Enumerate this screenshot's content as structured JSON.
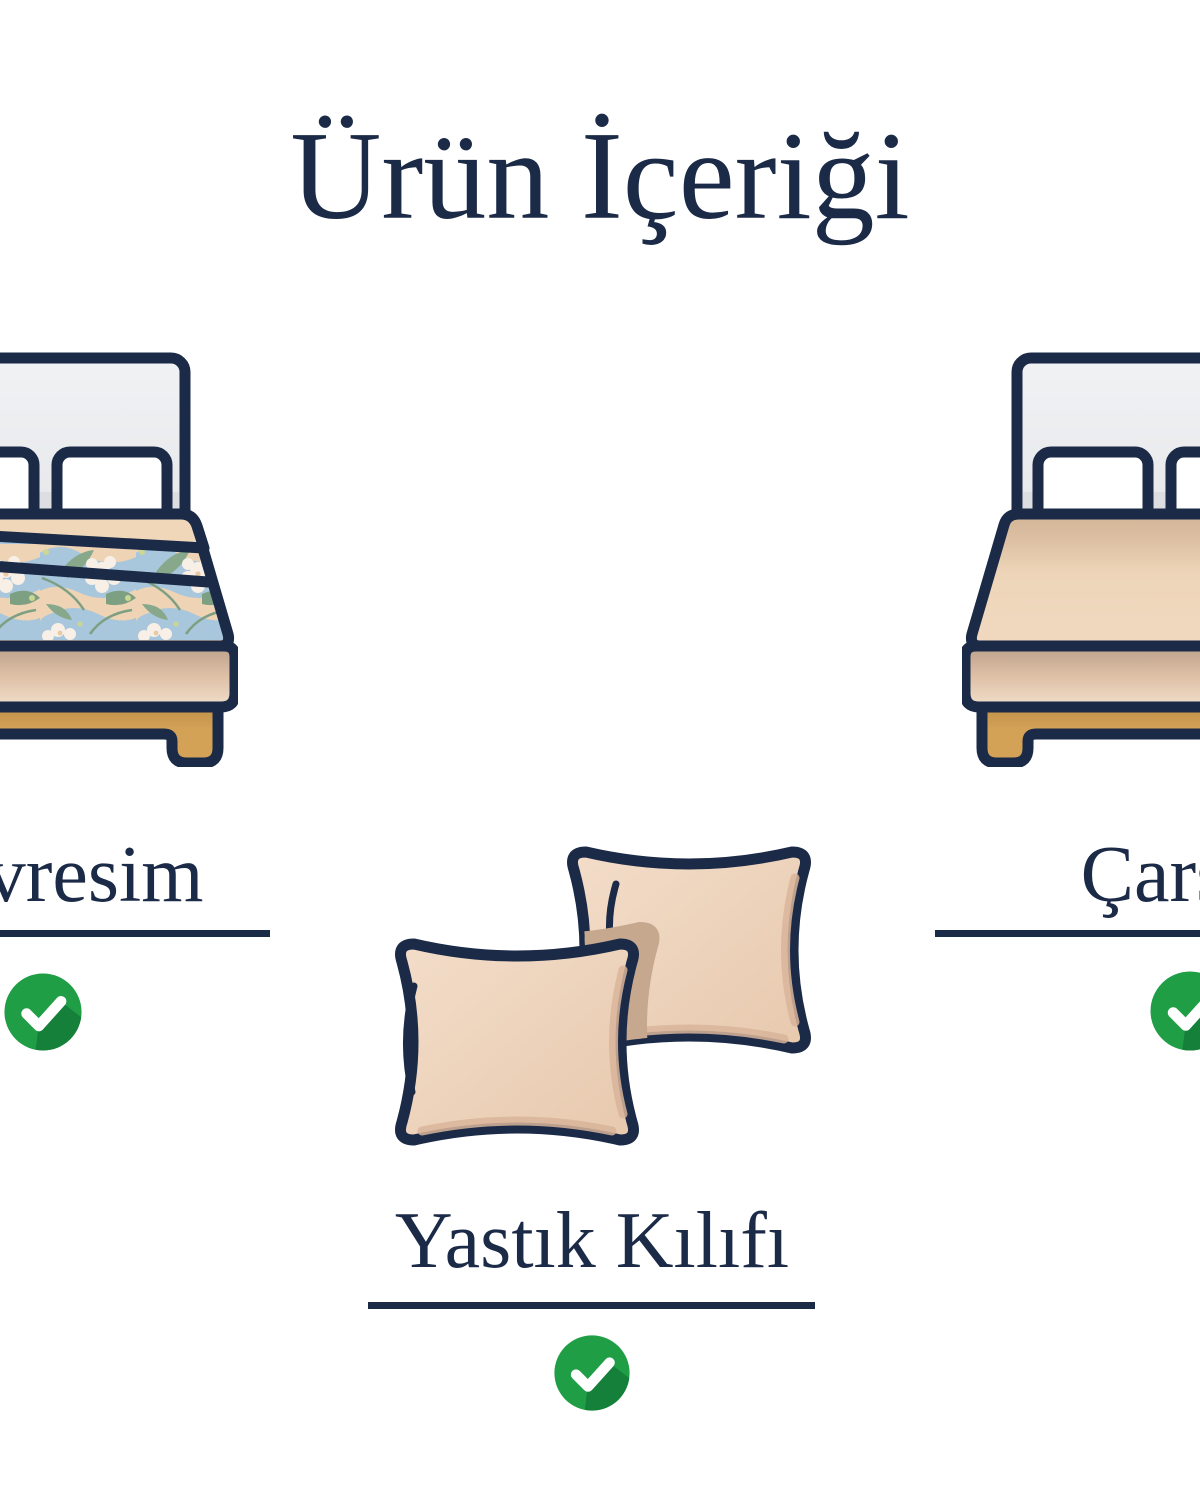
{
  "page": {
    "title": "Ürün İçeriği",
    "background": "#ffffff"
  },
  "items": [
    {
      "id": "nevresim",
      "label": "Nevresim",
      "included": true,
      "illustration": "bed-with-floral-duvet"
    },
    {
      "id": "yastik-kilifi",
      "label": "Yastık Kılıfı",
      "included": true,
      "illustration": "two-pillows"
    },
    {
      "id": "carsaf",
      "label": "Çarşaf",
      "included": true,
      "illustration": "bed-with-fitted-sheet"
    }
  ],
  "colors": {
    "navy": "#1b2a47",
    "check_green": "#1f9e45",
    "check_green_shadow": "#15803a",
    "check_mark": "#ffffff",
    "peach_fabric": "#eed6bb",
    "pillow_peach": "#ecd2ba",
    "headboard_gray": "#ededef",
    "wood_tan": "#d3a257",
    "duvet_blue": "#a9c7dc",
    "duvet_leaf_green": "#87a88b",
    "duvet_flower_white": "#f8efe6"
  }
}
